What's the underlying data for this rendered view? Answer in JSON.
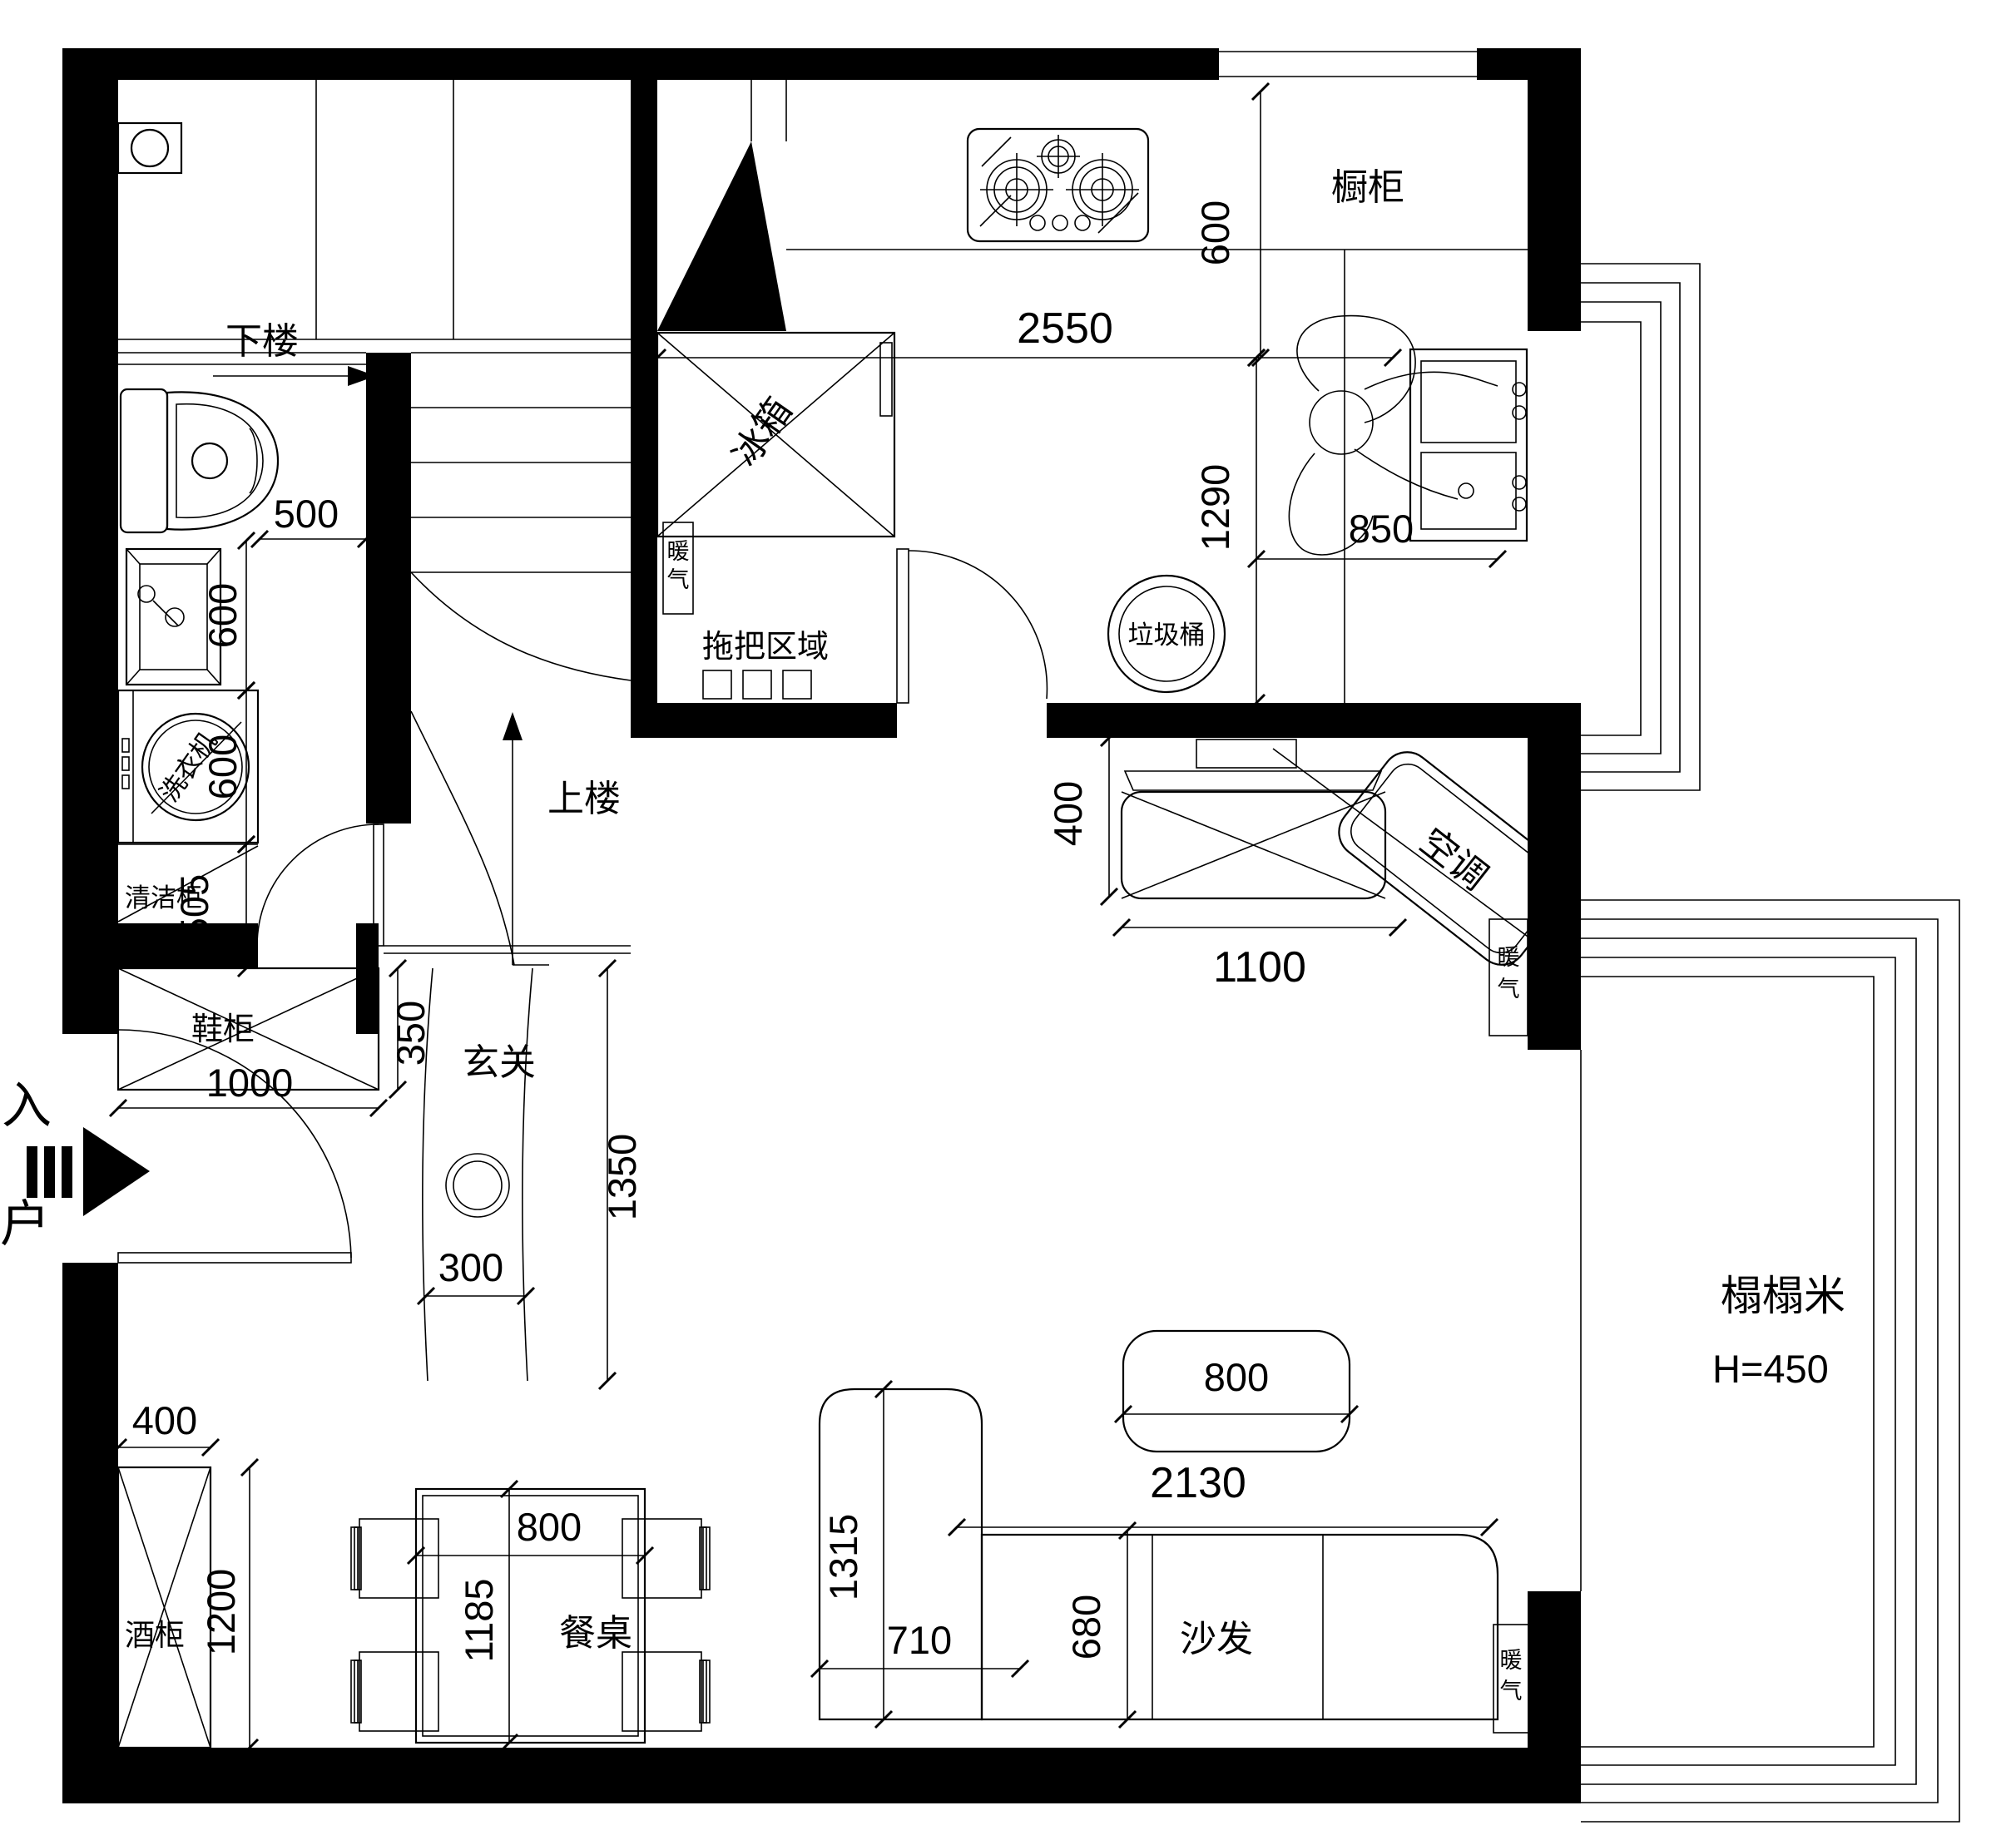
{
  "labels": {
    "stairs_down": "下楼",
    "stairs_up": "上楼",
    "fridge": "冰箱",
    "cupboard": "橱柜",
    "mop_area": "拖把区域",
    "trash": "垃圾桶",
    "ac": "空调",
    "cleaning_cabinet": "清洁柜",
    "washer": "洗衣机",
    "shoe_cabinet": "鞋柜",
    "foyer": "玄关",
    "entry_char1": "入",
    "entry_char2": "户",
    "radiator_char1": "暖",
    "radiator_char2": "气",
    "wine_cabinet": "酒柜",
    "dining_table": "餐桌",
    "sofa": "沙发",
    "tatami_name": "榻榻米",
    "tatami_height": "H=450"
  },
  "dims": {
    "bath_500": "500",
    "basin_600": "600",
    "washer_600": "600",
    "cabinet_505": "505",
    "kitchen_2550": "2550",
    "counter_600": "600",
    "kitchen_1290": "1290",
    "sink_850": "850",
    "tv_400": "400",
    "tv_1100": "1100",
    "shoe_1000": "1000",
    "shoe_350": "350",
    "foyer_300": "300",
    "foyer_1350": "1350",
    "wine_400": "400",
    "wine_1200": "1200",
    "table_800": "800",
    "table_1185": "1185",
    "coffee_800": "800",
    "sofa_2130": "2130",
    "chaise_1315": "1315",
    "chaise_710": "710",
    "sofa_680": "680"
  }
}
